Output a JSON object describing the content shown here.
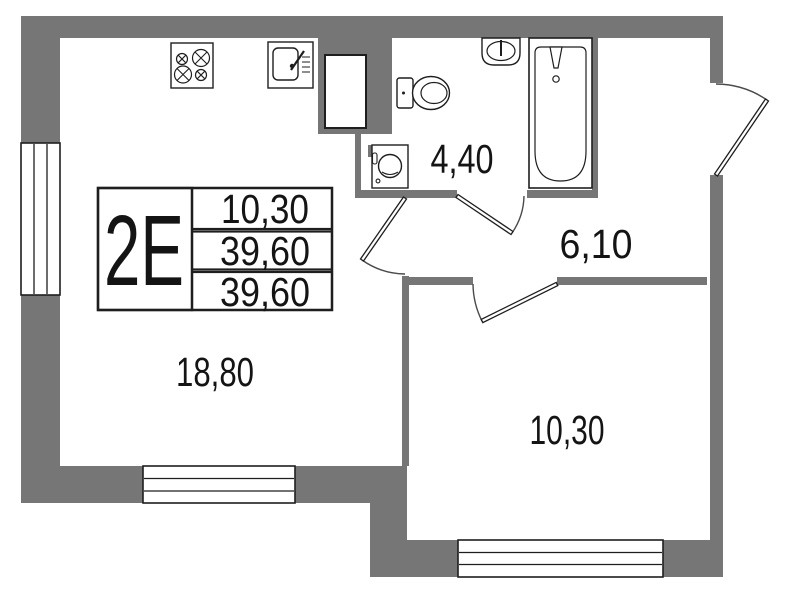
{
  "colors": {
    "wall": "#767676",
    "line": "#1e1e1e",
    "arc": "#4a4a4a",
    "background": "#ffffff"
  },
  "unit_card": {
    "unit_code": "2Е",
    "areas": [
      "10,30",
      "39,60",
      "39,60"
    ]
  },
  "room_labels": {
    "living_kitchen": "18,80",
    "bathroom": "4,40",
    "hallway": "6,10",
    "bedroom": "10,30"
  },
  "icons": {
    "stove": "stove-icon",
    "kitchen_sink": "kitchen-sink-icon",
    "vent_shaft": "vent-shaft",
    "toilet": "toilet-icon",
    "washbasin": "washbasin-icon",
    "bathtub": "bathtub-icon",
    "washing_machine": "washing-machine-icon",
    "entrance_door": "door-swing",
    "windows": "window"
  }
}
